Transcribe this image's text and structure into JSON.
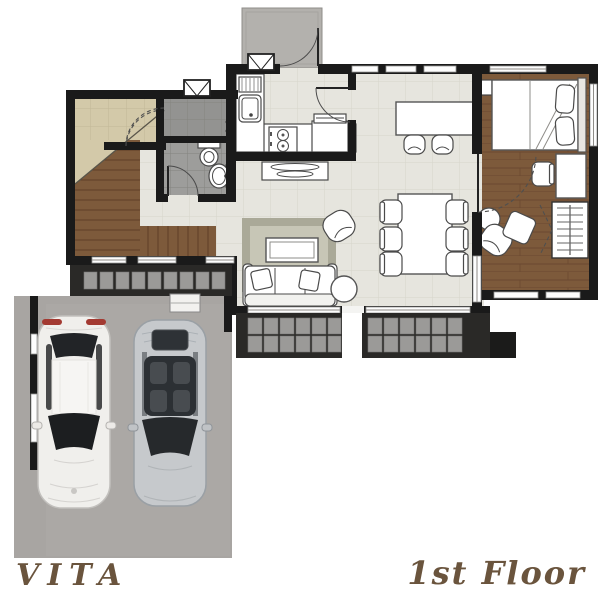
{
  "captions": {
    "project_name": "VITA",
    "floor_label": "1st Floor"
  },
  "palette": {
    "wall": "#1a1a1a",
    "room_tile": "#e6e5de",
    "entry_tile": "#d3c9a9",
    "bath_tile_upper": "#939391",
    "bath_tile_lower": "#9d9d9b",
    "wood_floor": "#7d5a3b",
    "porch_concrete": "#b3b1ad",
    "garage_concrete": "#a8a5a2",
    "deck_dark": "#2a2927",
    "paver": "#9b9a98",
    "rug_border": "#aaa998",
    "rug_center": "#c7c6b6",
    "caption_text": "#6a543d",
    "car_white_body": "#f0efec",
    "car_silver_body": "#c6c9cc",
    "taillight_red": "#a33a32"
  }
}
